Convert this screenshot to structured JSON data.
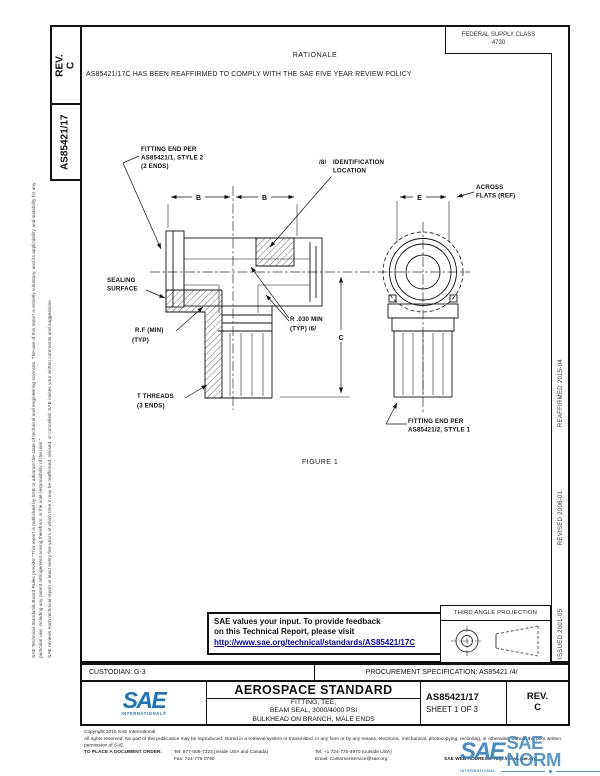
{
  "header": {
    "fsc_label": "FEDERAL SUPPLY CLASS",
    "fsc_value": "4730",
    "rationale_title": "RATIONALE",
    "rationale_text": "AS85421/17C HAS BEEN REAFFIRMED TO COMPLY WITH THE SAE FIVE YEAR REVIEW POLICY"
  },
  "sidebar": {
    "rev_label": "REV.",
    "rev_value": "C",
    "doc_number": "AS85421/17",
    "disclaimer_p1": "SAE Technical Standards Board Rules provide: “This report is published by SAE to advance the state of technical and engineering sciences. The use of this report is entirely voluntary, and its applicability and suitability for any particular use, including any patent infringement arising therefrom, is the sole responsibility of the user.”",
    "disclaimer_p2": "SAE reviews each technical report at least every five years at which time it may be reaffirmed, revised, or cancelled. SAE invites your written comments and suggestions."
  },
  "revision_history": {
    "issued": "ISSUED 2001-05",
    "revised": "REVISED 2006-01",
    "reaffirmed": "REAFFIRMED 2015-04"
  },
  "drawing": {
    "labels": {
      "fitting_end_1_l1": "FITTING END PER",
      "fitting_end_1_l2": "AS85421/1, STYLE 2",
      "fitting_end_1_l3": "(2 ENDS)",
      "id_marker": "/8/",
      "id_l1": "IDENTIFICATION",
      "id_l2": "LOCATION",
      "across_flats_l1": "ACROSS",
      "across_flats_l2": "FLATS (REF)",
      "sealing_l1": "SEALING",
      "sealing_l2": "SURFACE",
      "rf_l1": "R.F (MIN)",
      "rf_l2": "(TYP)",
      "r030_l1": "R .030 MIN",
      "r030_l2": "(TYP) /6/",
      "threads_l1": "T THREADS",
      "threads_l2": "(3 ENDS)",
      "fitting_end_2_l1": "FITTING END PER",
      "fitting_end_2_l2": "AS85421/2, STYLE 1"
    },
    "dims": {
      "b1": "B",
      "b2": "B",
      "e": "E",
      "c": "C"
    },
    "figure_caption": "FIGURE 1"
  },
  "feedback_box": {
    "line1": "SAE values your input. To provide feedback",
    "line2": "on this Technical Report, please visit",
    "link": "http://www.sae.org/technical/standards/AS85421/17C"
  },
  "projection": {
    "label": "THIRD ANGLE PROJECTION"
  },
  "footer": {
    "custodian": "CUSTODIAN: G-3",
    "procurement": "PROCUREMENT SPECIFICATION: AS85421 /4/",
    "doc_type": "AEROSPACE STANDARD",
    "title_line1": "FITTING, TEE,",
    "title_line2": "BEAM SEAL, 3000/4000 PSI",
    "title_line3": "BULKHEAD ON BRANCH, MALE ENDS",
    "doc_number": "AS85421/17",
    "sheet": "SHEET 1 OF 3",
    "rev_label": "REV.",
    "rev_value": "C",
    "sae_logo_text": "SAE",
    "sae_logo_sub": "INTERNATIONAL®"
  },
  "copyright": {
    "line1": "Copyright 2015 SAE International",
    "line2": "All rights reserved. No part of this publication may be reproduced, stored in a retrieval system or transmitted, in any form or by any means, electronic, mechanical, photocopying, recording, or otherwise, without the prior written permission of SAE.",
    "order_label": "TO PLACE A DOCUMENT ORDER:",
    "tel1": "Tel: 877-606-7323 (inside USA and Canada)",
    "tel2": "Tel: +1 724-776-4970 (outside USA)",
    "fax": "Fax: 724-776-0790",
    "email": "Email: CustomerService@sae.org",
    "web": "SAE WEB ADDRESS: http://www.sae.org"
  },
  "watermark": {
    "sae": "SAE",
    "text": "SAE NORM",
    "sub": "INTERNATIONAL."
  },
  "colors": {
    "link_blue": "#0000CC",
    "sae_blue": "#1B75BC",
    "watermark_blue": "#3E8AC6"
  }
}
